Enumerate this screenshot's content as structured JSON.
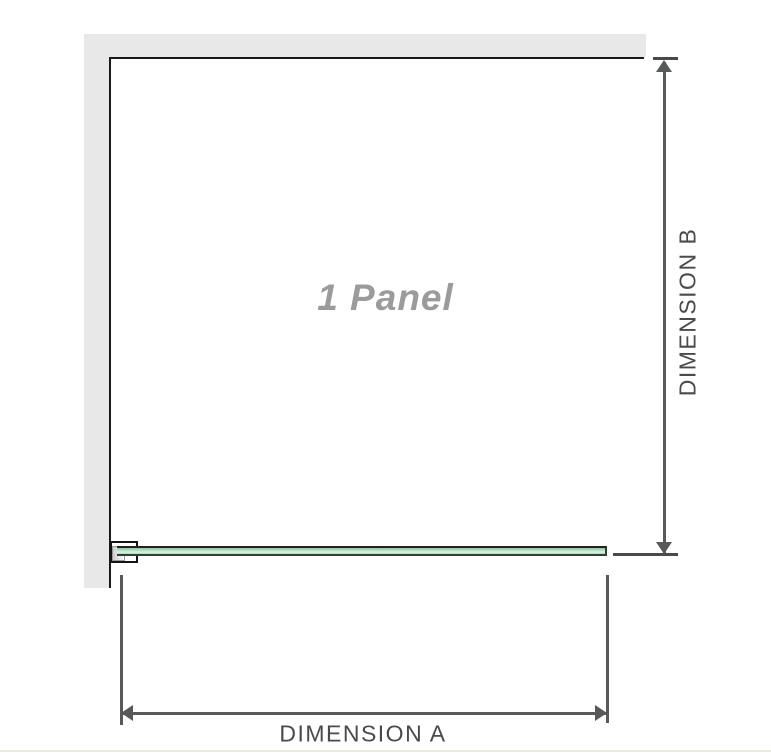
{
  "diagram": {
    "panel_label": "1 Panel",
    "dimension_a_label": "DIMENSION A",
    "dimension_b_label": "DIMENSION B"
  },
  "colors": {
    "wall": "#e8e8e8",
    "frame": "#1a1a1a",
    "dimension": "#58595b",
    "label": "#4a4a4d",
    "panel_text": "#9b9b9b",
    "glass_edge": "#222222",
    "glass_green_dark": "#84c7a0",
    "glass_green_light": "#def0e3",
    "baseline": "#edeae5"
  }
}
